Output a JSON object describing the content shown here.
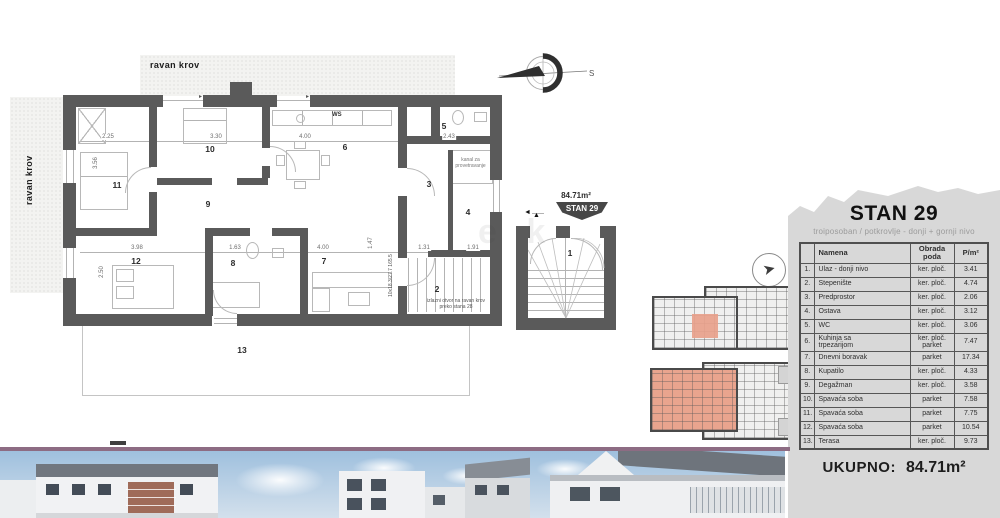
{
  "plan": {
    "roof_top": "ravan krov",
    "roof_left": "ravan krov",
    "ws": "WS",
    "area": "84.71m²",
    "badge": "S29",
    "stair_spec": "10x18.3/27.7  165.5",
    "watermark": "e k",
    "exit_note": "izlazni otvor na ravan krov\npreko stana 28",
    "shaft_note": "kanal za\nprovetravanje",
    "rooms": [
      {
        "n": "1",
        "x": 570,
        "y": 253
      },
      {
        "n": "2",
        "x": 437,
        "y": 289
      },
      {
        "n": "3",
        "x": 429,
        "y": 184
      },
      {
        "n": "4",
        "x": 468,
        "y": 212
      },
      {
        "n": "5",
        "x": 444,
        "y": 126
      },
      {
        "n": "6",
        "x": 345,
        "y": 147
      },
      {
        "n": "7",
        "x": 324,
        "y": 261
      },
      {
        "n": "8",
        "x": 233,
        "y": 263
      },
      {
        "n": "9",
        "x": 208,
        "y": 204
      },
      {
        "n": "10",
        "x": 210,
        "y": 149
      },
      {
        "n": "11",
        "x": 117,
        "y": 185
      },
      {
        "n": "12",
        "x": 136,
        "y": 261
      },
      {
        "n": "13",
        "x": 242,
        "y": 350
      }
    ],
    "dims": [
      {
        "t": "2.25",
        "x": 108,
        "y": 137
      },
      {
        "t": "3.30",
        "x": 216,
        "y": 137
      },
      {
        "t": "4.00",
        "x": 305,
        "y": 137
      },
      {
        "t": "2.43",
        "x": 449,
        "y": 137
      },
      {
        "t": "3.98",
        "x": 137,
        "y": 248
      },
      {
        "t": "1.63",
        "x": 235,
        "y": 248
      },
      {
        "t": "4.00",
        "x": 323,
        "y": 248
      },
      {
        "t": "1.31",
        "x": 424,
        "y": 248
      },
      {
        "t": "1.91",
        "x": 473,
        "y": 248
      },
      {
        "t": "3.56",
        "x": 96,
        "y": 163,
        "v": 1
      },
      {
        "t": "2.50",
        "x": 102,
        "y": 272,
        "v": 1
      },
      {
        "t": "1.47",
        "x": 371,
        "y": 243,
        "v": 1
      }
    ]
  },
  "icons": {
    "right_arrow": "▸",
    "left_arrow": "◄",
    "entry_marker": "▲",
    "key_arrow": "➤"
  },
  "compass": {
    "letter": "S"
  },
  "table": {
    "title": "STAN 29",
    "subtitle": "troiposoban / potkrovlje - donji + gornji nivo",
    "col_name": "Namena",
    "col_floor": "Obrada\npoda",
    "col_area": "P/m²",
    "rows": [
      {
        "n": "1.",
        "name": "Ulaz - donji nivo",
        "floor": "ker. ploč.",
        "area": "3.41"
      },
      {
        "n": "2.",
        "name": "Stepenište",
        "floor": "ker. ploč.",
        "area": "4.74"
      },
      {
        "n": "3.",
        "name": "Predprostor",
        "floor": "ker. ploč.",
        "area": "2.06"
      },
      {
        "n": "4.",
        "name": "Ostava",
        "floor": "ker. ploč.",
        "area": "3.12"
      },
      {
        "n": "5.",
        "name": "WC",
        "floor": "ker. ploč.",
        "area": "3.06"
      },
      {
        "n": "6.",
        "name": "Kuhinja sa\ntrpezarijom",
        "floor": "ker. ploč.\nparket",
        "area": "7.47"
      },
      {
        "n": "7.",
        "name": "Dnevni boravak",
        "floor": "parket",
        "area": "17.34"
      },
      {
        "n": "8.",
        "name": "Kupatilo",
        "floor": "ker. ploč.",
        "area": "4.33"
      },
      {
        "n": "9.",
        "name": "Degažman",
        "floor": "ker. ploč.",
        "area": "3.58"
      },
      {
        "n": "10.",
        "name": "Spavaća soba",
        "floor": "parket",
        "area": "7.58"
      },
      {
        "n": "11.",
        "name": "Spavaća soba",
        "floor": "parket",
        "area": "7.75"
      },
      {
        "n": "12.",
        "name": "Spavaća soba",
        "floor": "parket",
        "area": "10.54"
      },
      {
        "n": "13.",
        "name": "Terasa",
        "floor": "ker. ploč.",
        "area": "9.73"
      }
    ],
    "total_label": "UKUPNO:",
    "total_value": "84.71m²"
  }
}
